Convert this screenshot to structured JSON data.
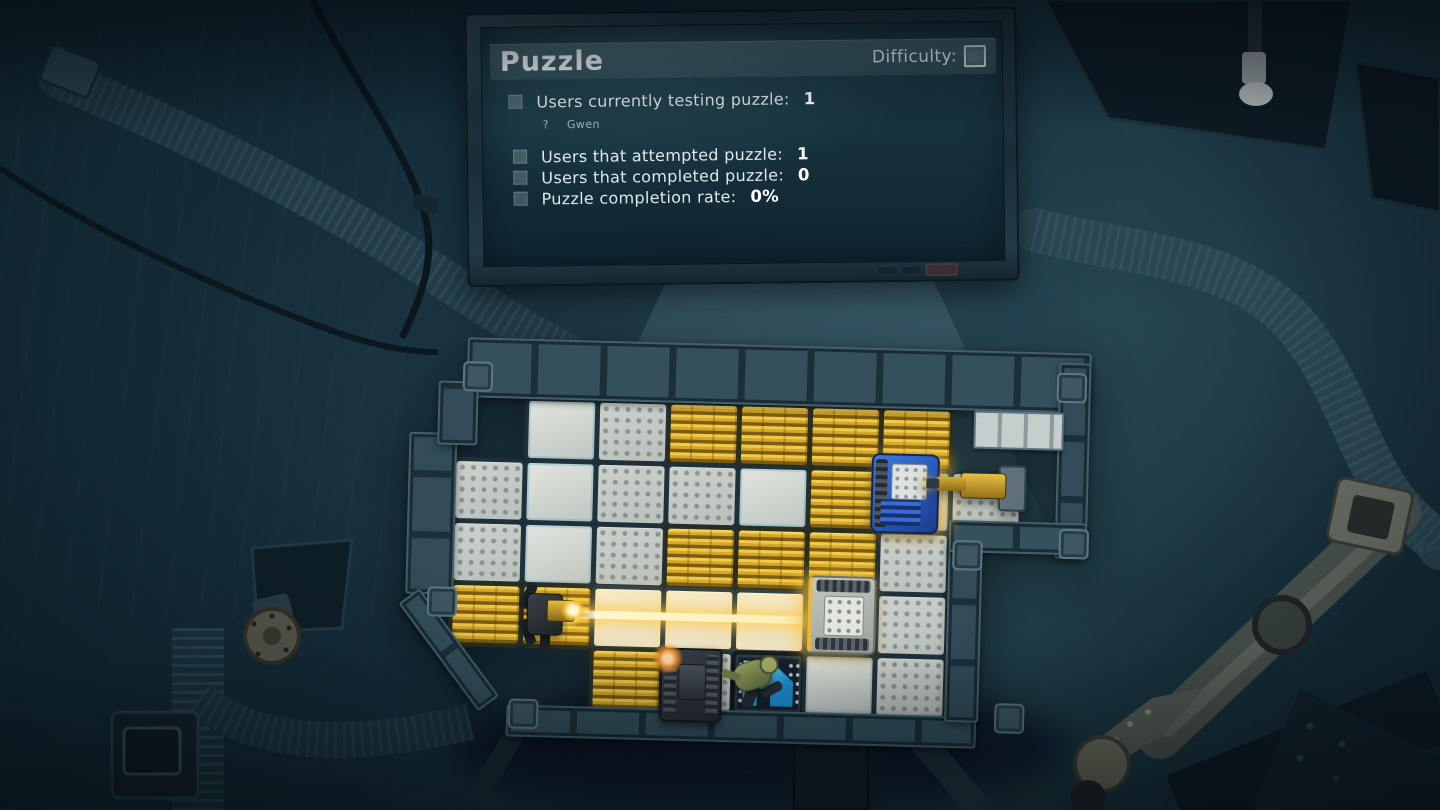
{
  "screen": {
    "title": "Puzzle",
    "difficulty_label": "Difficulty:",
    "stats": [
      {
        "label": "Users currently testing puzzle:",
        "value": "1"
      },
      {
        "label": "Users that attempted puzzle:",
        "value": "1"
      },
      {
        "label": "Users that completed puzzle:",
        "value": "0"
      },
      {
        "label": "Puzzle completion rate:",
        "value": "0%"
      }
    ],
    "testers": [
      {
        "bullet": "?",
        "name": "Gwen"
      }
    ]
  },
  "board": {
    "grid": {
      "rows": 5,
      "cols": 8
    },
    "tiles": [
      [
        "none",
        "white",
        "dots",
        "gold",
        "gold",
        "gold",
        "gold",
        "none"
      ],
      [
        "dots",
        "white",
        "dots",
        "dots",
        "white",
        "gold",
        "white",
        "dots"
      ],
      [
        "dots",
        "white",
        "dots",
        "gold",
        "gold",
        "gold",
        "dots",
        "none"
      ],
      [
        "gold",
        "gold",
        "lit",
        "lit",
        "lit",
        "white",
        "dots",
        "none"
      ],
      [
        "none",
        "none",
        "gold",
        "dots",
        "goal",
        "white",
        "dots",
        "none"
      ]
    ],
    "machines": [
      {
        "type": "laser-emitter",
        "row": 3,
        "col": 1,
        "dx": -12,
        "dy": -2
      },
      {
        "type": "laser-receiver",
        "row": 3,
        "col": 5,
        "dx": -2,
        "dy": -11
      },
      {
        "type": "blue-rover",
        "row": 1,
        "col": 6,
        "dx": -12,
        "dy": -10
      },
      {
        "type": "robot-arm",
        "row": 1,
        "col": 7,
        "dx": -10,
        "dy": -17
      },
      {
        "type": "turret",
        "row": 4,
        "col": 3,
        "dx": -8,
        "dy": 1
      },
      {
        "type": "player",
        "row": 4,
        "col": 4,
        "dx": -15,
        "dy": -3
      }
    ],
    "laser": {
      "row": 3,
      "from_col": 1,
      "to_col": 5
    }
  },
  "colors": {
    "gold_tile": "#e0b032",
    "laser": "#ffefb4",
    "goal_glow": "#3fd0f5",
    "screen_bg": "#16323e",
    "room_bg": "#142c39"
  }
}
